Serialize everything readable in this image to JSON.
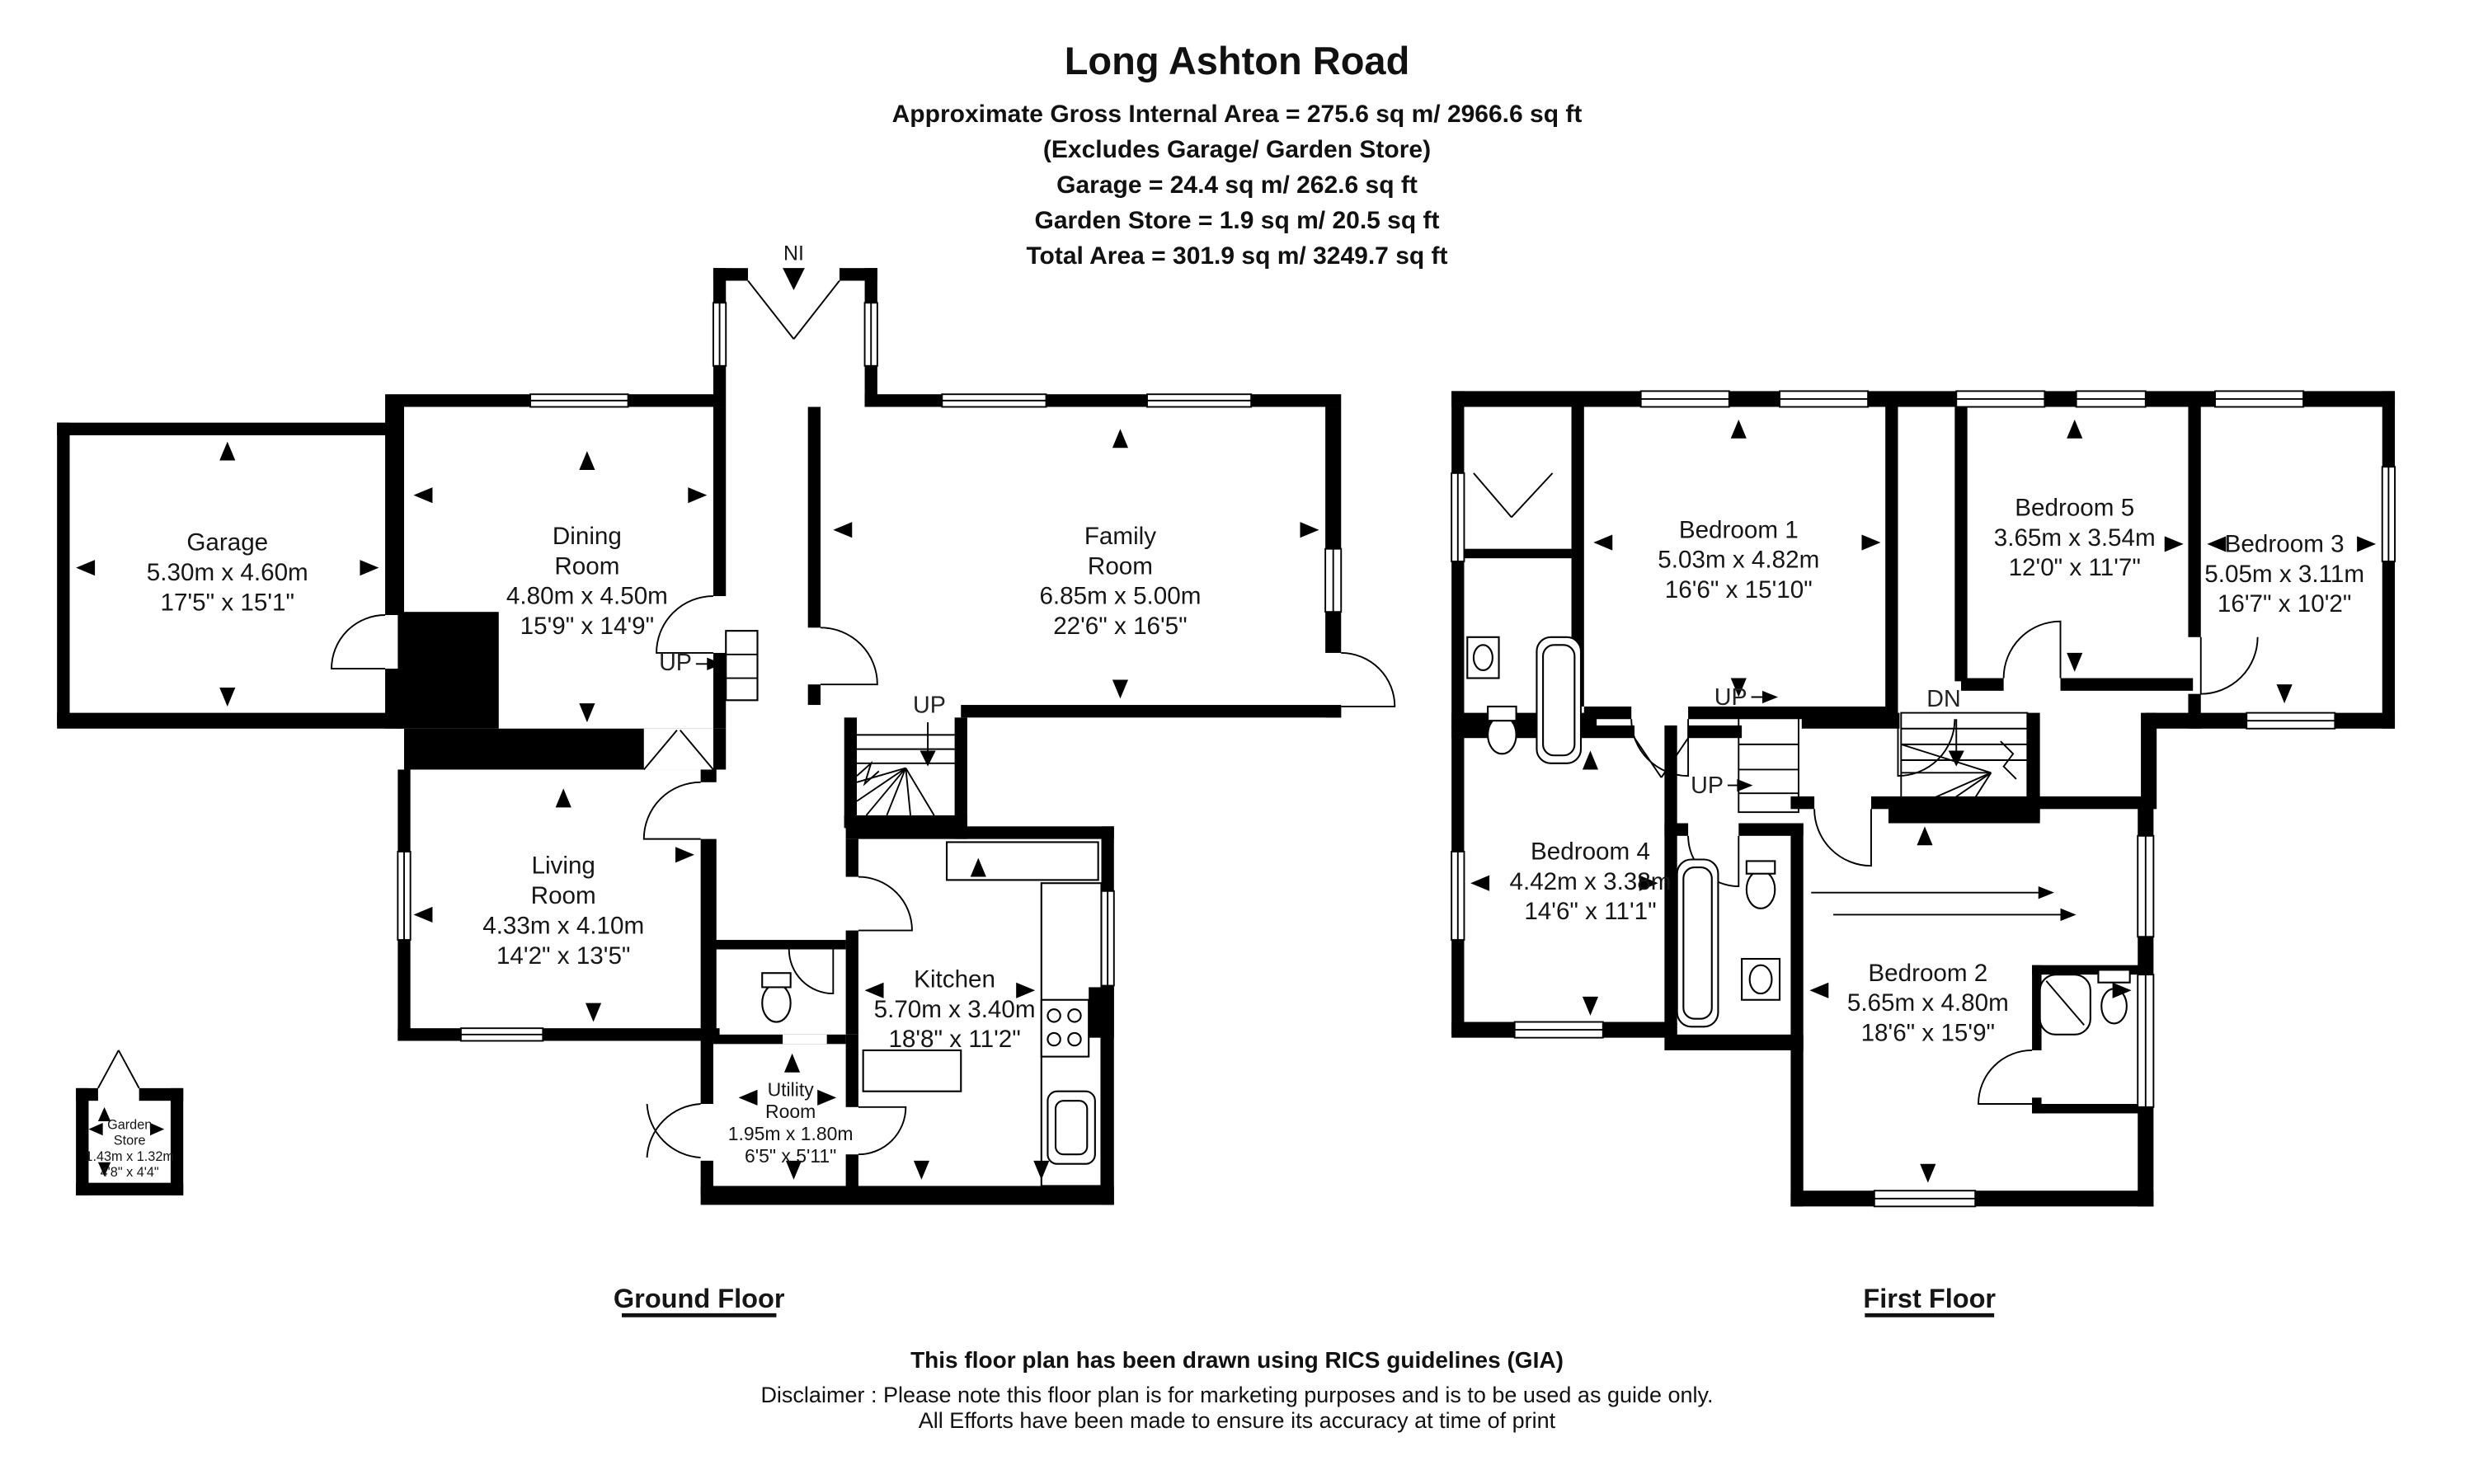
{
  "header": {
    "title": "Long Ashton Road",
    "lines": [
      "Approximate Gross Internal Area = 275.6 sq m/ 2966.6 sq ft",
      "(Excludes Garage/ Garden Store)",
      "Garage = 24.4 sq m/ 262.6 sq ft",
      "Garden Store = 1.9 sq m/ 20.5 sq ft",
      "Total Area = 301.9 sq m/ 3249.7 sq ft"
    ]
  },
  "ground_floor": {
    "title": "Ground Floor",
    "entrance_label": "NI",
    "up_label_1": "UP",
    "up_label_2": "UP",
    "rooms": {
      "garage": {
        "lines": [
          "Garage",
          "5.30m x 4.60m",
          "17'5\" x 15'1\""
        ]
      },
      "dining": {
        "lines": [
          "Dining",
          "Room",
          "4.80m x 4.50m",
          "15'9\" x 14'9\""
        ]
      },
      "family": {
        "lines": [
          "Family",
          "Room",
          "6.85m x 5.00m",
          "22'6\" x 16'5\""
        ]
      },
      "living": {
        "lines": [
          "Living",
          "Room",
          "4.33m x 4.10m",
          "14'2\" x 13'5\""
        ]
      },
      "kitchen": {
        "lines": [
          "Kitchen",
          "5.70m x 3.40m",
          "18'8\" x 11'2\""
        ]
      },
      "utility": {
        "lines": [
          "Utility",
          "Room",
          "1.95m x 1.80m",
          "6'5\" x 5'11\""
        ]
      },
      "garden_store": {
        "lines": [
          "Garden",
          "Store",
          "1.43m x 1.32m",
          "4'8\" x 4'4\""
        ]
      }
    }
  },
  "first_floor": {
    "title": "First Floor",
    "dn_label": "DN",
    "up_label_1": "UP",
    "up_label_2": "UP",
    "rooms": {
      "bedroom1": {
        "lines": [
          "Bedroom 1",
          "5.03m x 4.82m",
          "16'6\" x 15'10\""
        ]
      },
      "bedroom2": {
        "lines": [
          "Bedroom 2",
          "5.65m x 4.80m",
          "18'6\" x 15'9\""
        ]
      },
      "bedroom3": {
        "lines": [
          "Bedroom 3",
          "5.05m x 3.11m",
          "16'7\" x 10'2\""
        ]
      },
      "bedroom4": {
        "lines": [
          "Bedroom 4",
          "4.42m x 3.38m",
          "14'6\" x 11'1\""
        ]
      },
      "bedroom5": {
        "lines": [
          "Bedroom 5",
          "3.65m x 3.54m",
          "12'0\" x 11'7\""
        ]
      }
    }
  },
  "footer": {
    "line1": "This floor plan has been drawn using RICS guidelines (GIA)",
    "line2": "Disclaimer : Please note this floor plan is for marketing purposes and is to be used as guide only.",
    "line3": "All Efforts have been made to ensure its accuracy at time of print"
  }
}
